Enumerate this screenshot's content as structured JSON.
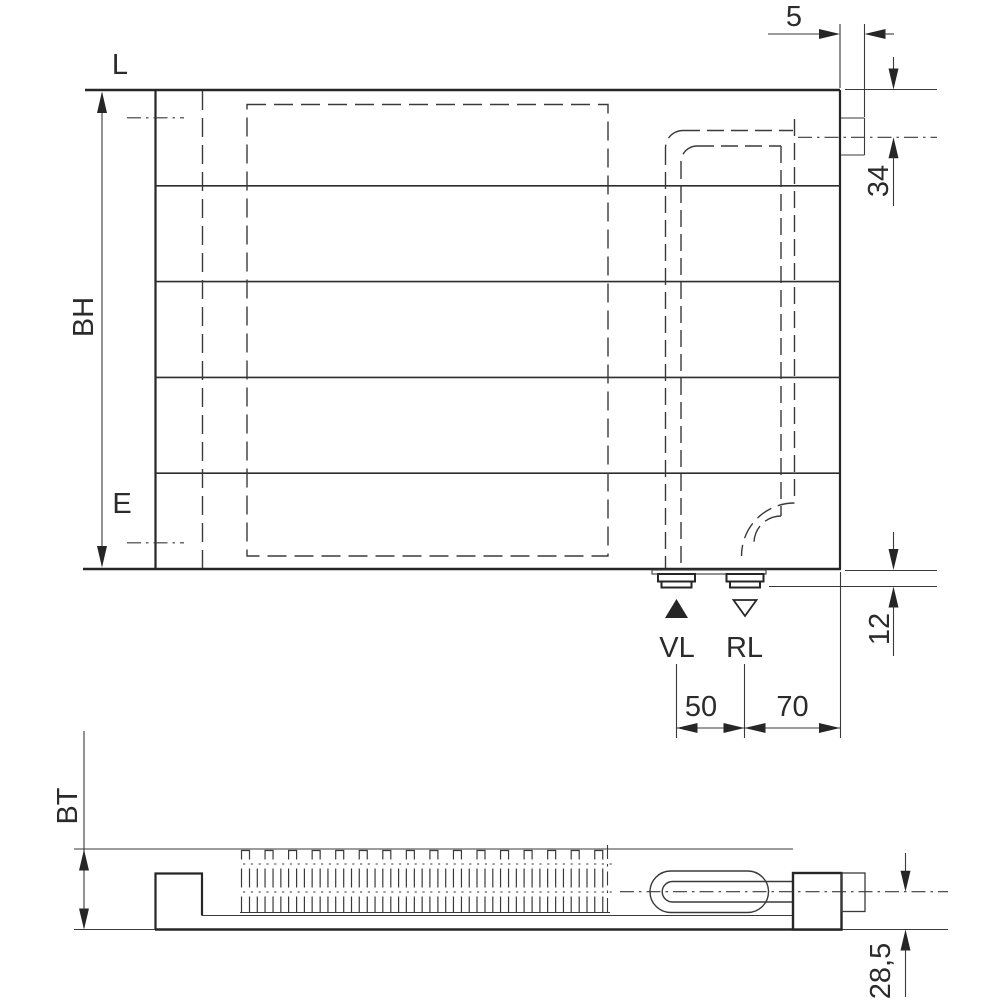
{
  "drawing": {
    "background": "#ffffff",
    "line_color": "#2b2b2b",
    "labels": {
      "length": "L",
      "build_height": "BH",
      "connection_offset": "E",
      "build_depth": "BT",
      "supply": "VL",
      "return_flow": "RL"
    },
    "dims": {
      "stub": "5",
      "top_offset": "34",
      "bottom_offset": "12",
      "vl_rl": "50",
      "rl_edge": "70",
      "axis_depth": "28,5"
    }
  }
}
